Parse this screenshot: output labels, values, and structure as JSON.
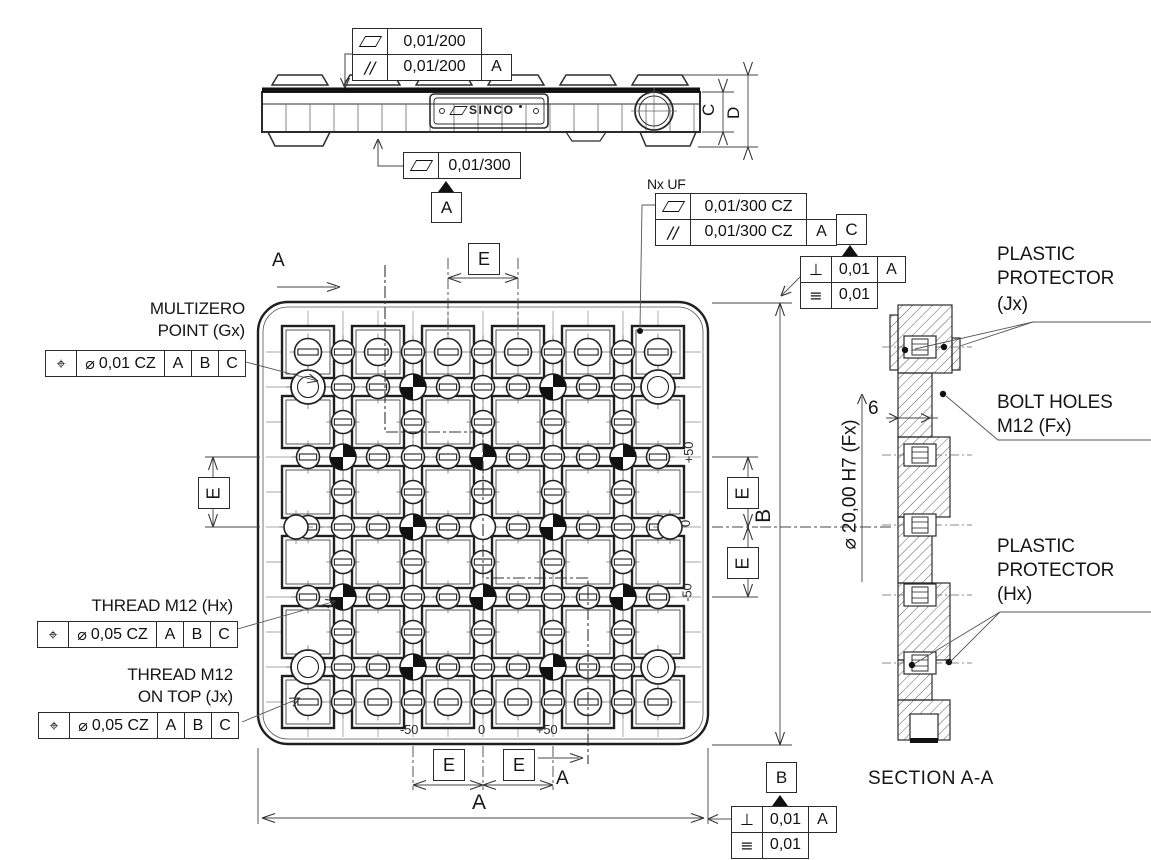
{
  "brand": "SINCO",
  "callouts": {
    "flat200": "0,01/200",
    "par200": "0,01/200",
    "par200_datum": "A",
    "flat300": "0,01/300",
    "flat300_datum": "A",
    "nx_uf": "Nx UF",
    "flat300cz": "0,01/300 CZ",
    "par300cz": "0,01/300 CZ",
    "par300cz_datum": "A",
    "datum_c": "C",
    "c_perp": "0,01",
    "c_perp_datum": "A",
    "c_sym": "0,01",
    "datum_b": "B",
    "b_perp": "0,01",
    "b_perp_datum": "A",
    "b_sym": "0,01",
    "symbols": {
      "position": "⌖",
      "diameter": "⌀",
      "perpendicular": "⊥",
      "symmetry": "≡",
      "parallel": "//"
    }
  },
  "features": {
    "multizero": {
      "line1": "MULTIZERO",
      "line2": "POINT (Gx)",
      "tol": "0,01 CZ",
      "datums": [
        "A",
        "B",
        "C"
      ]
    },
    "thread_hx": {
      "line1": "THREAD M12 (Hx)",
      "tol": "0,05 CZ",
      "datums": [
        "A",
        "B",
        "C"
      ]
    },
    "thread_jx": {
      "line1": "THREAD M12",
      "line2": "ON TOP (Jx)",
      "tol": "0,05 CZ",
      "datums": [
        "A",
        "B",
        "C"
      ]
    },
    "protector_jx": {
      "line1": "PLASTIC",
      "line2": "PROTECTOR",
      "line3": "(Jx)"
    },
    "bolt_holes": {
      "line1": "BOLT HOLES",
      "line2": "M12 (Fx)"
    },
    "protector_hx": {
      "line1": "PLASTIC",
      "line2": "PROTECTOR",
      "line3": "(Hx)"
    },
    "bore": "⌀ 20,00 H7 (Fx)",
    "offset": "6"
  },
  "dims": {
    "a": "A",
    "b": "B",
    "c": "C",
    "d": "D",
    "e": "E",
    "cut": "A",
    "section_title": "SECTION A-A"
  },
  "coords": {
    "bottom": [
      "-50",
      "0",
      "+50"
    ],
    "right": [
      "+50",
      "0",
      "-50"
    ]
  },
  "plan_grid": {
    "rows": 6,
    "cols": 6
  }
}
